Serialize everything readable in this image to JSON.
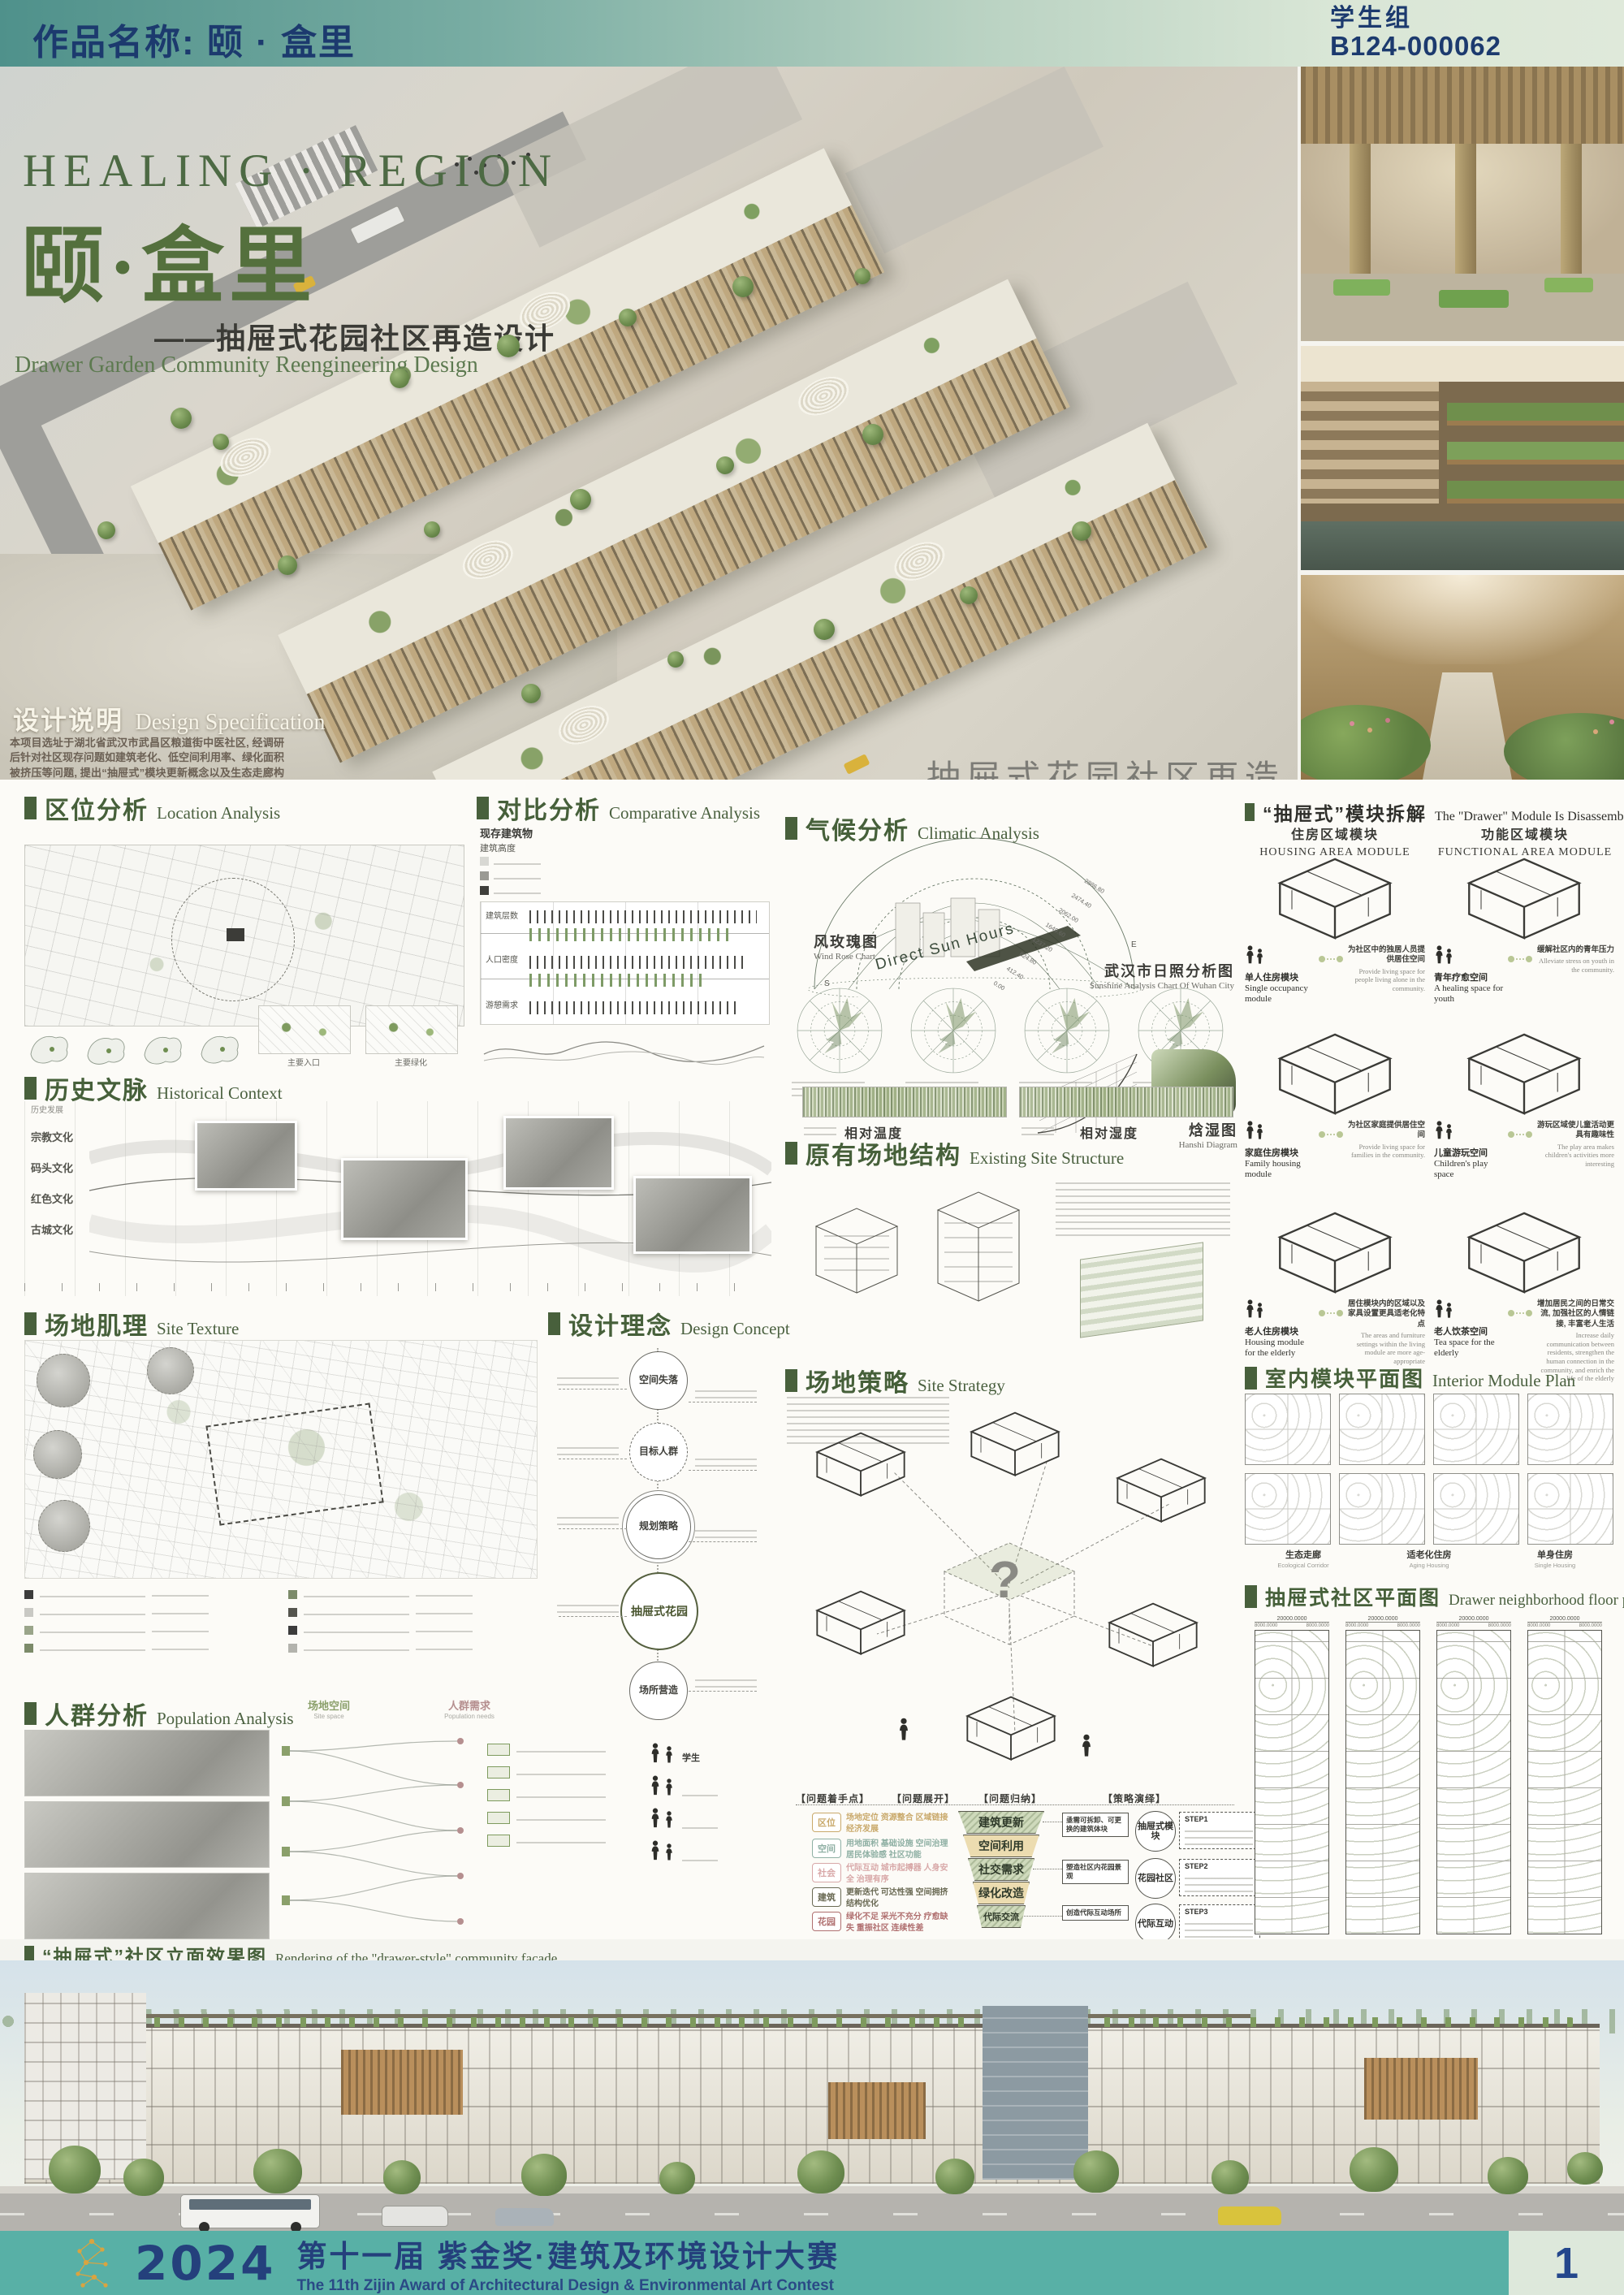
{
  "header": {
    "work_label": "作品名称: 颐 · 盒里",
    "group": "学生组",
    "entry_id": "B124-000062"
  },
  "hero": {
    "title_en": "HEALING · REGION",
    "title_cn": "颐·盒里",
    "subtitle_cn": "——抽屉式花园社区再造设计",
    "subtitle_en": "Drawer Garden Community Reengineering Design",
    "watermark_cn": "抽屉式花园社区再造设计",
    "watermark_en1": "DRAWER GARDEN COMMUNITY",
    "watermark_en2": "REENGINEERING DESIGN",
    "spec_title_cn": "设计说明",
    "spec_title_en": "Design Specification",
    "spec_p1": "本项目选址于湖北省武汉市武昌区粮道街中医社区, 经调研后针对社区现存问题如建筑老化、低空间利用率、绿化面积被挤压等问题, 提出“抽屉式”模块更新概念以及生态走廊构想, 旨在针对不同人群构建不同抽屉式模块, 置入社区建筑体块中, 搭配起重机和滑轨实现建筑更新迭代, 有效解决建筑老化, 更新周期长等问题; 生态走廊构想是充分保障空间利用率的同时缓解了绿化面积被挤压问题, 让社区居民能够在此慢下来, 发挥自然疗愈功能; 生态走廊配合连桥在串联社区的同时保障了抽屉式社区模块的私密性及互动性。",
    "spec_p2": "“抽屉式花园社区”构想揭示了老旧社区建筑更新问题解决方案以及重返自然的城市愿景, 提出了一套“抽屉式花园”社区文化综合体。"
  },
  "sections": {
    "location": {
      "cn": "区位分析",
      "en": "Location Analysis",
      "cap1": "主要入口",
      "cap2": "主要绿化"
    },
    "comparative": {
      "cn": "对比分析",
      "en": "Comparative Analysis",
      "legend_title": "现存建筑物",
      "legend_sub": "建筑高度",
      "rows": [
        "建筑层数",
        "人口密度",
        "游憩需求"
      ]
    },
    "climate": {
      "cn": "气候分析",
      "en": "Climatic Analysis",
      "sun_label": "Direct Sun Hours",
      "sun_values": [
        "0.00",
        "412.40",
        "824.80",
        "1237.20",
        "1649.60",
        "2062.00",
        "2474.40",
        "2886.80"
      ],
      "compass_s": "S",
      "compass_e": "E",
      "sunshine_cn": "武汉市日照分析图",
      "sunshine_en": "Sunshine Analysis Chart Of Wuhan City",
      "windrose_cn": "风玫瑰图",
      "windrose_en": "Wind Rose Chart",
      "hanshi_cn": "焓湿图",
      "hanshi_en": "Hanshi Diagram",
      "strip1": "相对温度",
      "strip2": "相对湿度"
    },
    "module": {
      "cn": "“抽屉式”模块拆解",
      "en": "The \"Drawer\" Module Is Disassembled",
      "col1_cn": "住房区域模块",
      "col1_en": "HOUSING AREA MODULE",
      "col2_cn": "功能区域模块",
      "col2_en": "FUNCTIONAL AREA MODULE",
      "items": [
        {
          "cn": "单人住房模块",
          "en": "Single occupancy module",
          "desc_cn": "为社区中的独居人员提供居住空间",
          "desc_en": "Provide living space for people living alone in the community."
        },
        {
          "cn": "青年疗愈空间",
          "en": "A healing space for youth",
          "desc_cn": "缓解社区内的青年压力",
          "desc_en": "Alleviate stress on youth in the community."
        },
        {
          "cn": "家庭住房模块",
          "en": "Family housing module",
          "desc_cn": "为社区家庭提供居住空间",
          "desc_en": "Provide living space for families in the community."
        },
        {
          "cn": "儿童游玩空间",
          "en": "Children's play space",
          "desc_cn": "游玩区域使儿童活动更具有趣味性",
          "desc_en": "The play area makes children's activities more interesting"
        },
        {
          "cn": "老人住房模块",
          "en": "Housing module for the elderly",
          "desc_cn": "居住模块内的区域以及家具设置更具适老化特点",
          "desc_en": "The areas and furniture settings within the living module are more age-appropriate"
        },
        {
          "cn": "老人饮茶空间",
          "en": "Tea space for the elderly",
          "desc_cn": "增加居民之间的日常交流, 加强社区的人情链接, 丰富老人生活",
          "desc_en": "Increase daily communication between residents, strengthen the human connection in the community, and enrich the life of the elderly"
        }
      ]
    },
    "history": {
      "cn": "历史文脉",
      "en": "Historical Context",
      "axis_label": "历史发展",
      "axis": [
        "宗教文化",
        "码头文化",
        "红色文化",
        "古城文化"
      ]
    },
    "existing": {
      "cn": "原有场地结构",
      "en": "Existing Site Structure"
    },
    "texture": {
      "cn": "场地肌理",
      "en": "Site Texture"
    },
    "concept": {
      "cn": "设计理念",
      "en": "Design Concept",
      "circles": [
        "空间失落",
        "目标人群",
        "规划策略",
        "抽屉式花园",
        "场所营造"
      ]
    },
    "strategy": {
      "cn": "场地策略",
      "en": "Site Strategy",
      "question": "?",
      "flow_headers": [
        "【问题着手点】",
        "【问题展开】",
        "【问题归纳】",
        "【策略演绎】"
      ],
      "categories": [
        "区位",
        "空间",
        "社会",
        "建筑",
        "花园"
      ],
      "keywords": [
        "场地定位 资源整合 区域链接 经济发展",
        "用地面积 基础设施 空间治理 居民体验感 社区功能",
        "代际互动 城市起搏器 人身安全 治理有序",
        "更新迭代 可达性强 空间拥挤 结构优化",
        "绿化不足 采光不充分 疗愈缺失 重振社区 连续性差"
      ],
      "funnel": [
        "建筑更新",
        "空间利用",
        "社交需求",
        "绿化改造",
        "代际交流"
      ],
      "mid_boxes": [
        "亟需可拆卸、可更换的建筑体块",
        "塑造社区内花园景观",
        "创造代际互动场所"
      ],
      "steps": [
        {
          "label": "抽屉式模块",
          "step": "STEP1"
        },
        {
          "label": "花园社区",
          "step": "STEP2"
        },
        {
          "label": "代际互动",
          "step": "STEP3"
        }
      ]
    },
    "interior": {
      "cn": "室内模块平面图",
      "en": "Interior Module Plan",
      "cap1_cn": "生态走廊",
      "cap1_en": "Ecological Corridor",
      "cap2_cn": "适老化住房",
      "cap2_en": "Aging Housing",
      "cap3_cn": "单身住房",
      "cap3_en": "Single Housing"
    },
    "floorplan": {
      "cn": "抽屉式社区平面图",
      "en": "Drawer neighborhood floor plan",
      "dim_a": "20000.0000",
      "dim_b": "8000.0000"
    },
    "population": {
      "cn": "人群分析",
      "en": "Population Analysis",
      "col1_cn": "场地空间",
      "col1_en": "Site space",
      "col2_cn": "人群需求",
      "col2_en": "Population needs",
      "person1": "学生"
    }
  },
  "facade": {
    "cn": "“抽屉式”社区立面效果图",
    "en": "Rendering of the \"drawer-style\" community façade"
  },
  "footer": {
    "year": "2024",
    "title_cn": "第十一届 紫金奖·建筑及环境设计大赛",
    "title_en": "The 11th Zijin Award of Architectural Design & Environmental Art Contest",
    "page": "1"
  }
}
